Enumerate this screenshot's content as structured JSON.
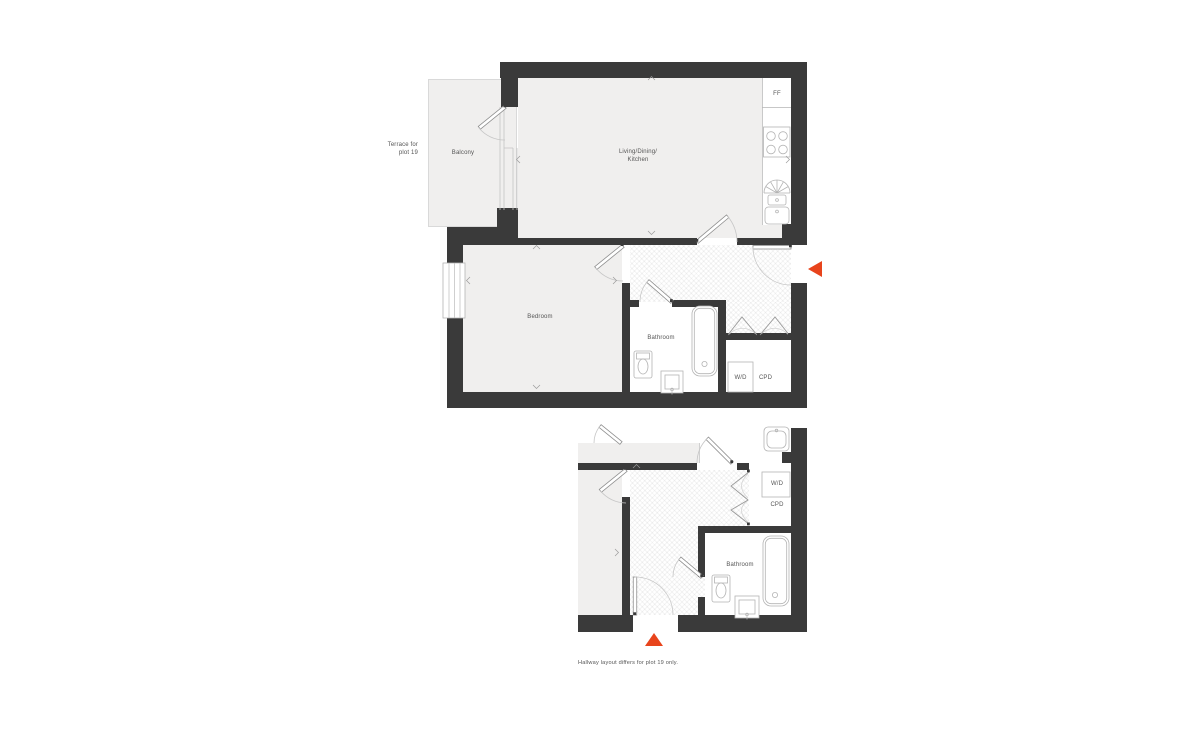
{
  "colors": {
    "wall": "#3a3a3a",
    "room_fill": "#f0efee",
    "accent": "#e8441c",
    "fixture_outline": "#b4b4b4",
    "text": "#555555"
  },
  "labels": {
    "terrace_line1": "Terrace for",
    "terrace_line2": "plot 19",
    "balcony": "Balcony",
    "living_line1": "Living/Dining/",
    "living_line2": "Kitchen",
    "ff": "FF",
    "bedroom": "Bedroom",
    "bathroom": "Bathroom",
    "wd": "W/D",
    "cpd": "CPD"
  },
  "small_plan": {
    "wd": "W/D",
    "cpd": "CPD",
    "bathroom": "Bathroom"
  },
  "icons": {
    "entrance_main": "triangle-left",
    "entrance_secondary": "triangle-up"
  },
  "caption": "Hallway layout differs for plot 19 only."
}
